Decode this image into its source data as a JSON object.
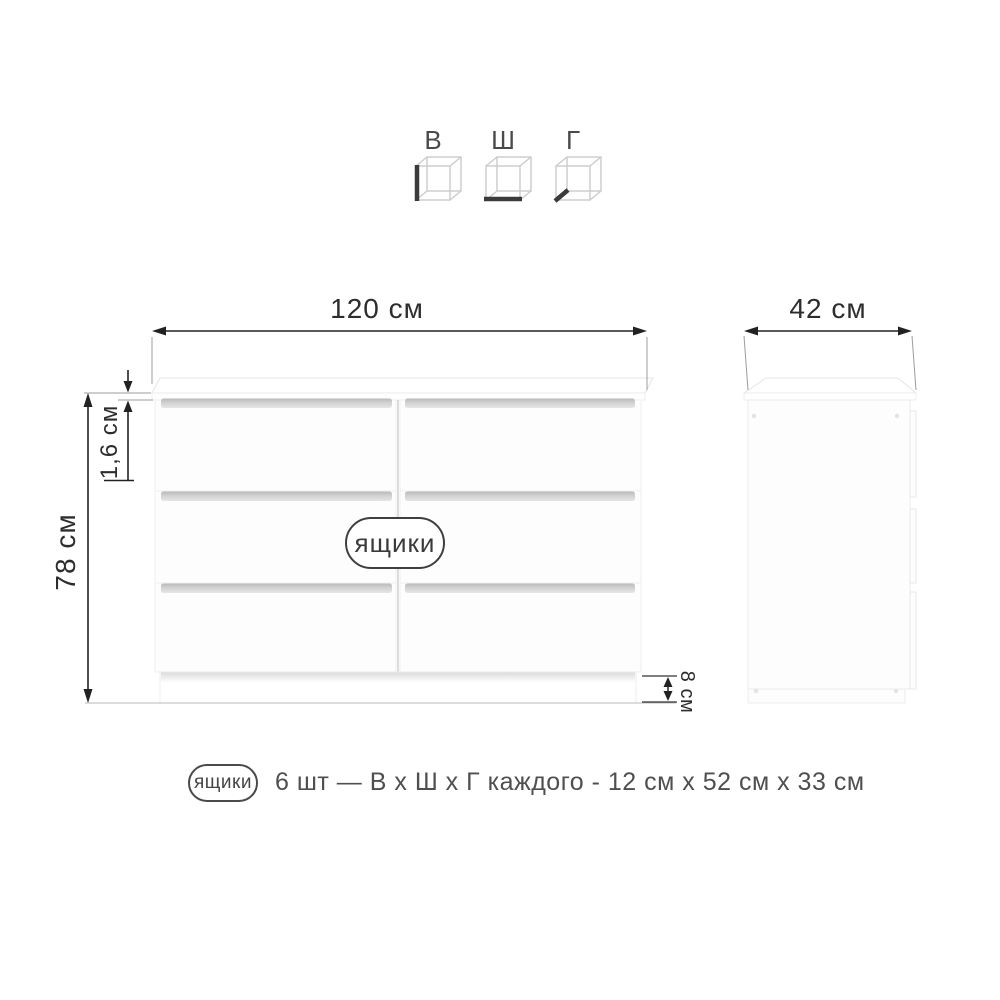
{
  "dimension_key": {
    "height_label": "В",
    "width_label": "Ш",
    "depth_label": "Г"
  },
  "front_view": {
    "width": "120 см",
    "height": "78 см",
    "top_panel_thickness": "1,6 см",
    "plinth_height": "8 см",
    "drawers_badge": "ящики"
  },
  "side_view": {
    "depth": "42 см"
  },
  "legend": {
    "badge": "ящики",
    "description": "6 шт — В х Ш х Г каждого - 12 см х 52 см х 33 см"
  },
  "colors": {
    "dimension_line": "#222222",
    "extension_line": "#9c9c9c",
    "furniture_outline": "#e4e4e4",
    "handle_recess": "#cccccc",
    "badge_border": "#3f3f3f",
    "legend_text": "#4f4f4f"
  }
}
